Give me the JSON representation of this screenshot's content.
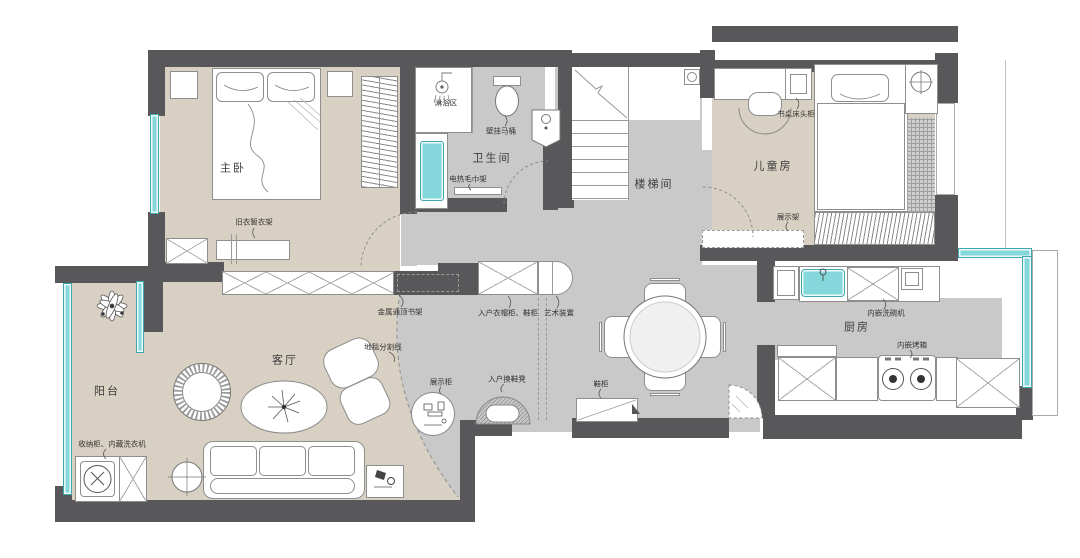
{
  "rooms": {
    "master": "主卧",
    "bath": "卫生间",
    "stair": "楼梯间",
    "kids": "儿童房",
    "living": "客厅",
    "balcony": "阳台",
    "dining": "餐厅",
    "kitchen": "厨房"
  },
  "annotations": {
    "clothes_rack": "旧衣暂衣架",
    "shower_zone": "淋浴区",
    "wall_hung_toilet": "壁挂马桶",
    "towel_rack": "电热毛巾架",
    "desk_nightstand": "书桌床头柜",
    "display_rack": "展示架",
    "metal_bookshelf": "金属通顶书架",
    "carpet_divider": "地毯分割线",
    "storage_washer": "收纳柜、内藏洗衣机",
    "display_cabinet": "展示柜",
    "entry_bench": "入户换鞋凳",
    "entry_wardrobe": "入户衣帽柜、鞋柜",
    "art_installation": "艺术装置",
    "shoe_cabinet": "鞋柜",
    "dishwasher": "内嵌洗碗机",
    "oven": "内嵌烤箱"
  },
  "colors": {
    "wall": "#58585a",
    "floor_warm": "#d8d0c2",
    "floor_gray": "#c9c9c9",
    "window": "#84d8dc"
  }
}
